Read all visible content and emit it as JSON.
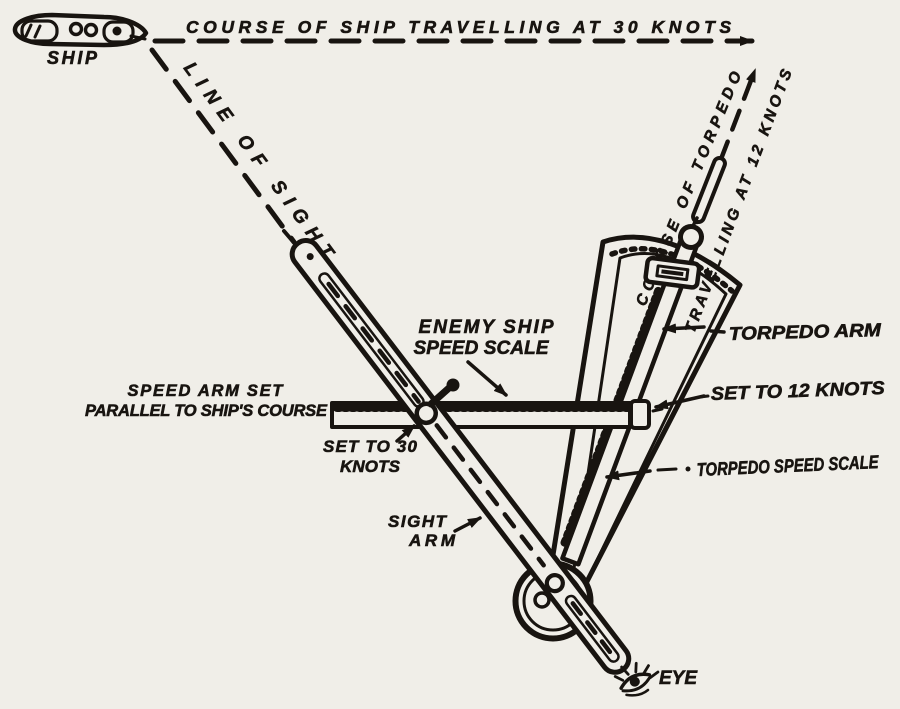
{
  "colors": {
    "paper": "#f0eee8",
    "ink": "#181410"
  },
  "ship": {
    "label": "SHIP"
  },
  "course_of_ship": {
    "label": "COURSE OF SHIP TRAVELLING AT 30 KNOTS",
    "speed_knots": 30
  },
  "line_of_sight": {
    "label": "LINE OF SIGHT"
  },
  "course_of_torpedo": {
    "line1": "COURSE OF TORPEDO",
    "line2": "TRAVELLING AT 12 KNOTS",
    "speed_knots": 12
  },
  "callouts": {
    "enemy_ship_speed_scale": {
      "line1": "ENEMY SHIP",
      "line2": "SPEED SCALE"
    },
    "speed_arm": {
      "line1": "SPEED ARM SET",
      "line2": "PARALLEL TO SHIP'S COURSE"
    },
    "speed_arm_setting": {
      "line1": "SET TO 30",
      "line2": "KNOTS"
    },
    "torpedo_arm": {
      "label": "TORPEDO ARM"
    },
    "torpedo_arm_setting": {
      "label": "SET TO 12 KNOTS"
    },
    "torpedo_speed_scale": {
      "label": "TORPEDO SPEED SCALE"
    },
    "sight_arm": {
      "line1": "SIGHT",
      "line2": "ARM"
    },
    "eye": {
      "label": "EYE"
    }
  }
}
